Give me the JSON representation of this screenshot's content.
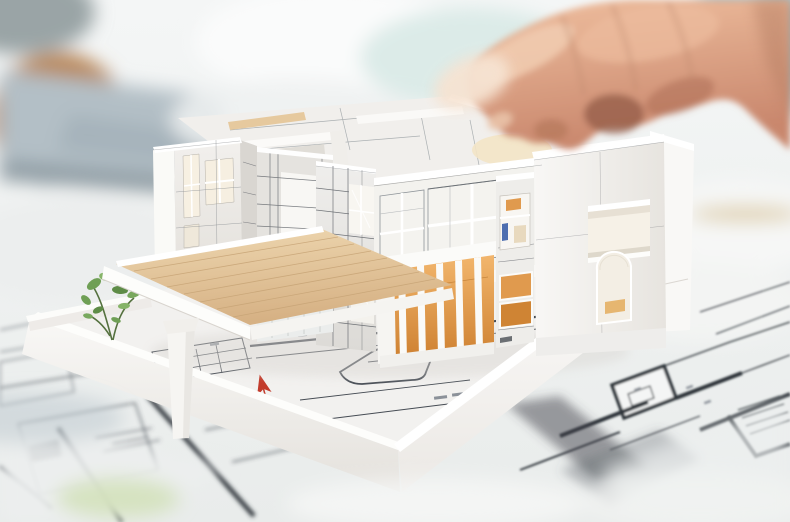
{
  "scene": {
    "type": "photograph",
    "setting": "bright architect desk, shallow depth of field",
    "description": "A hand reaches in from the top right and touches the open roof edge of a white architectural scale model of a modern two-storey house. The model stands on a white base tray printed with floor plans (including a red north arrow, a rounded driveway outline and a miniature green plant). The desk beneath is covered with blueprint floor-plan sheets; a blurred laptop and a wooden object sit in the background at top left, and teal clothing of the person is blurred at top right.",
    "subjects": {
      "hand": {
        "name": "architect-hand",
        "position": "top-right",
        "gesture": "thumb and fingers touching the model roof parapet"
      },
      "model_house": {
        "name": "architectural-scale-model",
        "style": "modern flat-roof two-storey villa, roofless top showing interior walls",
        "features": [
          "open roof terrace",
          "cantilevered wooden deck on white column",
          "warm-lit ground floor with vertical white slats",
          "square window",
          "arched window",
          "panelled facade grid",
          "large glazed upper floor"
        ]
      },
      "base_tray": {
        "name": "model-base-tray",
        "features": [
          "printed floor plan",
          "red north arrow",
          "rounded driveway outline",
          "miniature plant",
          "white parapet walls"
        ]
      },
      "desk": {
        "name": "blueprint-covered-desk",
        "features": [
          "floor-plan sheets with thick wall lines",
          "blurred laptop top-left",
          "blurred wooden object",
          "teal clothing top-right",
          "soft white foreground blur"
        ]
      }
    }
  },
  "palette": {
    "bg_top": "#f4f6f6",
    "bg_bottom": "#e9eceb",
    "laptop_gray": "#b3bfc6",
    "laptop_dark": "#8e9ba3",
    "wood_brown": "#b9895c",
    "cyan_tint": "#dcebe8",
    "teal_clothing": "#6e99a7",
    "model_white": "#f4f3f1",
    "model_bright": "#ffffff",
    "model_shadow": "#d9d6d1",
    "base_surface": "#f2f1ef",
    "wood_deck_light": "#eed7b0",
    "wood_deck_dark": "#d6b184",
    "orange_light": "#f2b66d",
    "orange_deep": "#cd7f2f",
    "warm_orange": "#e09a4e",
    "warm_orange_deep": "#cf8434",
    "glass": "#f4f3ef",
    "panel_line": "#5c6066",
    "blueprint_line": "#454b53",
    "blueprint_wall": "#2f353b",
    "skin_light": "#efbf9f",
    "skin_dark": "#c9876d",
    "skin_pale": "#f6e3d2",
    "skin_shadow": "#8e5743",
    "red_marker": "#c23b2b",
    "plant_green": "#6f9f55",
    "plant_green_light": "#86b468",
    "plant_green_dark": "#5e8c47",
    "accent_blue": "#3a5fa8",
    "detail_red_brown": "#7a2f1a"
  }
}
